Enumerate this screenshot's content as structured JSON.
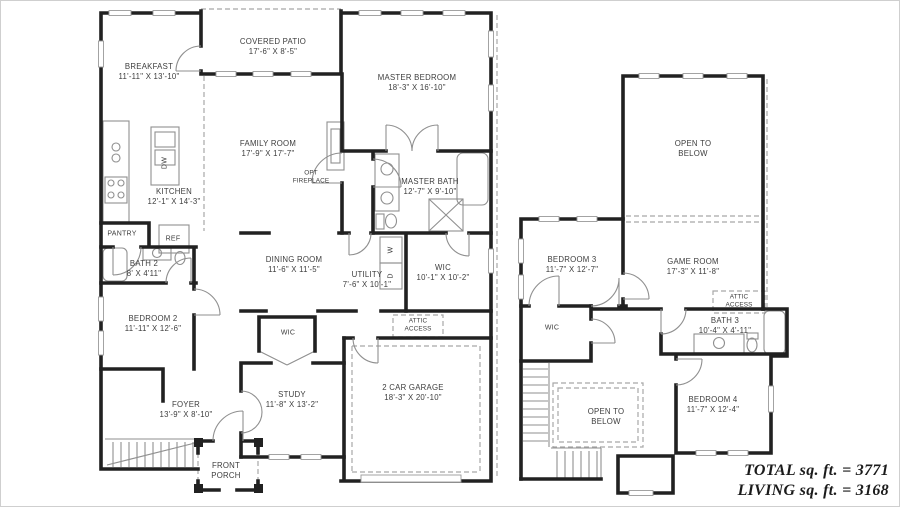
{
  "colors": {
    "wall": "#212121",
    "thin_line": "#8f8f8f",
    "dashed_line": "#a8a8a8",
    "label_text": "#3d3d3d",
    "footer_text": "#1b1b1b",
    "background": "#ffffff"
  },
  "first_floor": {
    "covered_patio": {
      "name": "COVERED PATIO",
      "dims": "17'-6\" X 8'-5\""
    },
    "breakfast": {
      "name": "BREAKFAST",
      "dims": "11'-11\" X 13'-10\""
    },
    "master_bedroom": {
      "name": "MASTER BEDROOM",
      "dims": "18'-3\" X 16'-10\""
    },
    "family_room": {
      "name": "FAMILY ROOM",
      "dims": "17'-9\" X 17'-7\""
    },
    "opt_fireplace": {
      "name": "OPT FIREPLACE"
    },
    "kitchen": {
      "name": "KITCHEN",
      "dims": "12'-1\" X 14'-3\""
    },
    "island_dishwasher": {
      "name": "DW"
    },
    "master_bath": {
      "name": "MASTER BATH",
      "dims": "12'-7\" X 9'-10\""
    },
    "pantry": {
      "name": "PANTRY"
    },
    "refrigerator": {
      "name": "REF"
    },
    "bath2": {
      "name": "BATH 2",
      "dims": "8' X 4'11\""
    },
    "dining_room": {
      "name": "DINING ROOM",
      "dims": "11'-6\" X 11'-5\""
    },
    "utility": {
      "name": "UTILITY",
      "dims": "7'-6\" X 10'-1\""
    },
    "washer": {
      "name": "W"
    },
    "dryer": {
      "name": "D"
    },
    "wic_master": {
      "name": "WIC",
      "dims": "10'-1\" X 10'-2\""
    },
    "bedroom2": {
      "name": "BEDROOM 2",
      "dims": "11'-11\" X 12'-6\""
    },
    "wic_hall": {
      "name": "WIC"
    },
    "attic_access": {
      "name": "ATTIC ACCESS"
    },
    "foyer": {
      "name": "FOYER",
      "dims": "13'-9\" X 8'-10\""
    },
    "study": {
      "name": "STUDY",
      "dims": "11'-8\" X 13'-2\""
    },
    "front_porch": {
      "name": "FRONT PORCH"
    },
    "garage": {
      "name": "2 CAR GARAGE",
      "dims": "18'-3\" X 20'-10\""
    }
  },
  "second_floor": {
    "open_to_below_top": {
      "name": "OPEN TO BELOW"
    },
    "bedroom3": {
      "name": "BEDROOM 3",
      "dims": "11'-7\" X 12'-7\""
    },
    "game_room": {
      "name": "GAME ROOM",
      "dims": "17'-3\" X 11'-8\""
    },
    "attic_access": {
      "name": "ATTIC ACCESS"
    },
    "wic": {
      "name": "WIC"
    },
    "bath3": {
      "name": "BATH 3",
      "dims": "10'-4\" X 4'-11\""
    },
    "bedroom4": {
      "name": "BEDROOM 4",
      "dims": "11'-7\" X 12'-4\""
    },
    "open_to_below_bottom": {
      "name": "OPEN TO BELOW"
    }
  },
  "footer": {
    "total": "TOTAL sq. ft. = 3771",
    "living": "LIVING sq. ft. = 3168"
  }
}
